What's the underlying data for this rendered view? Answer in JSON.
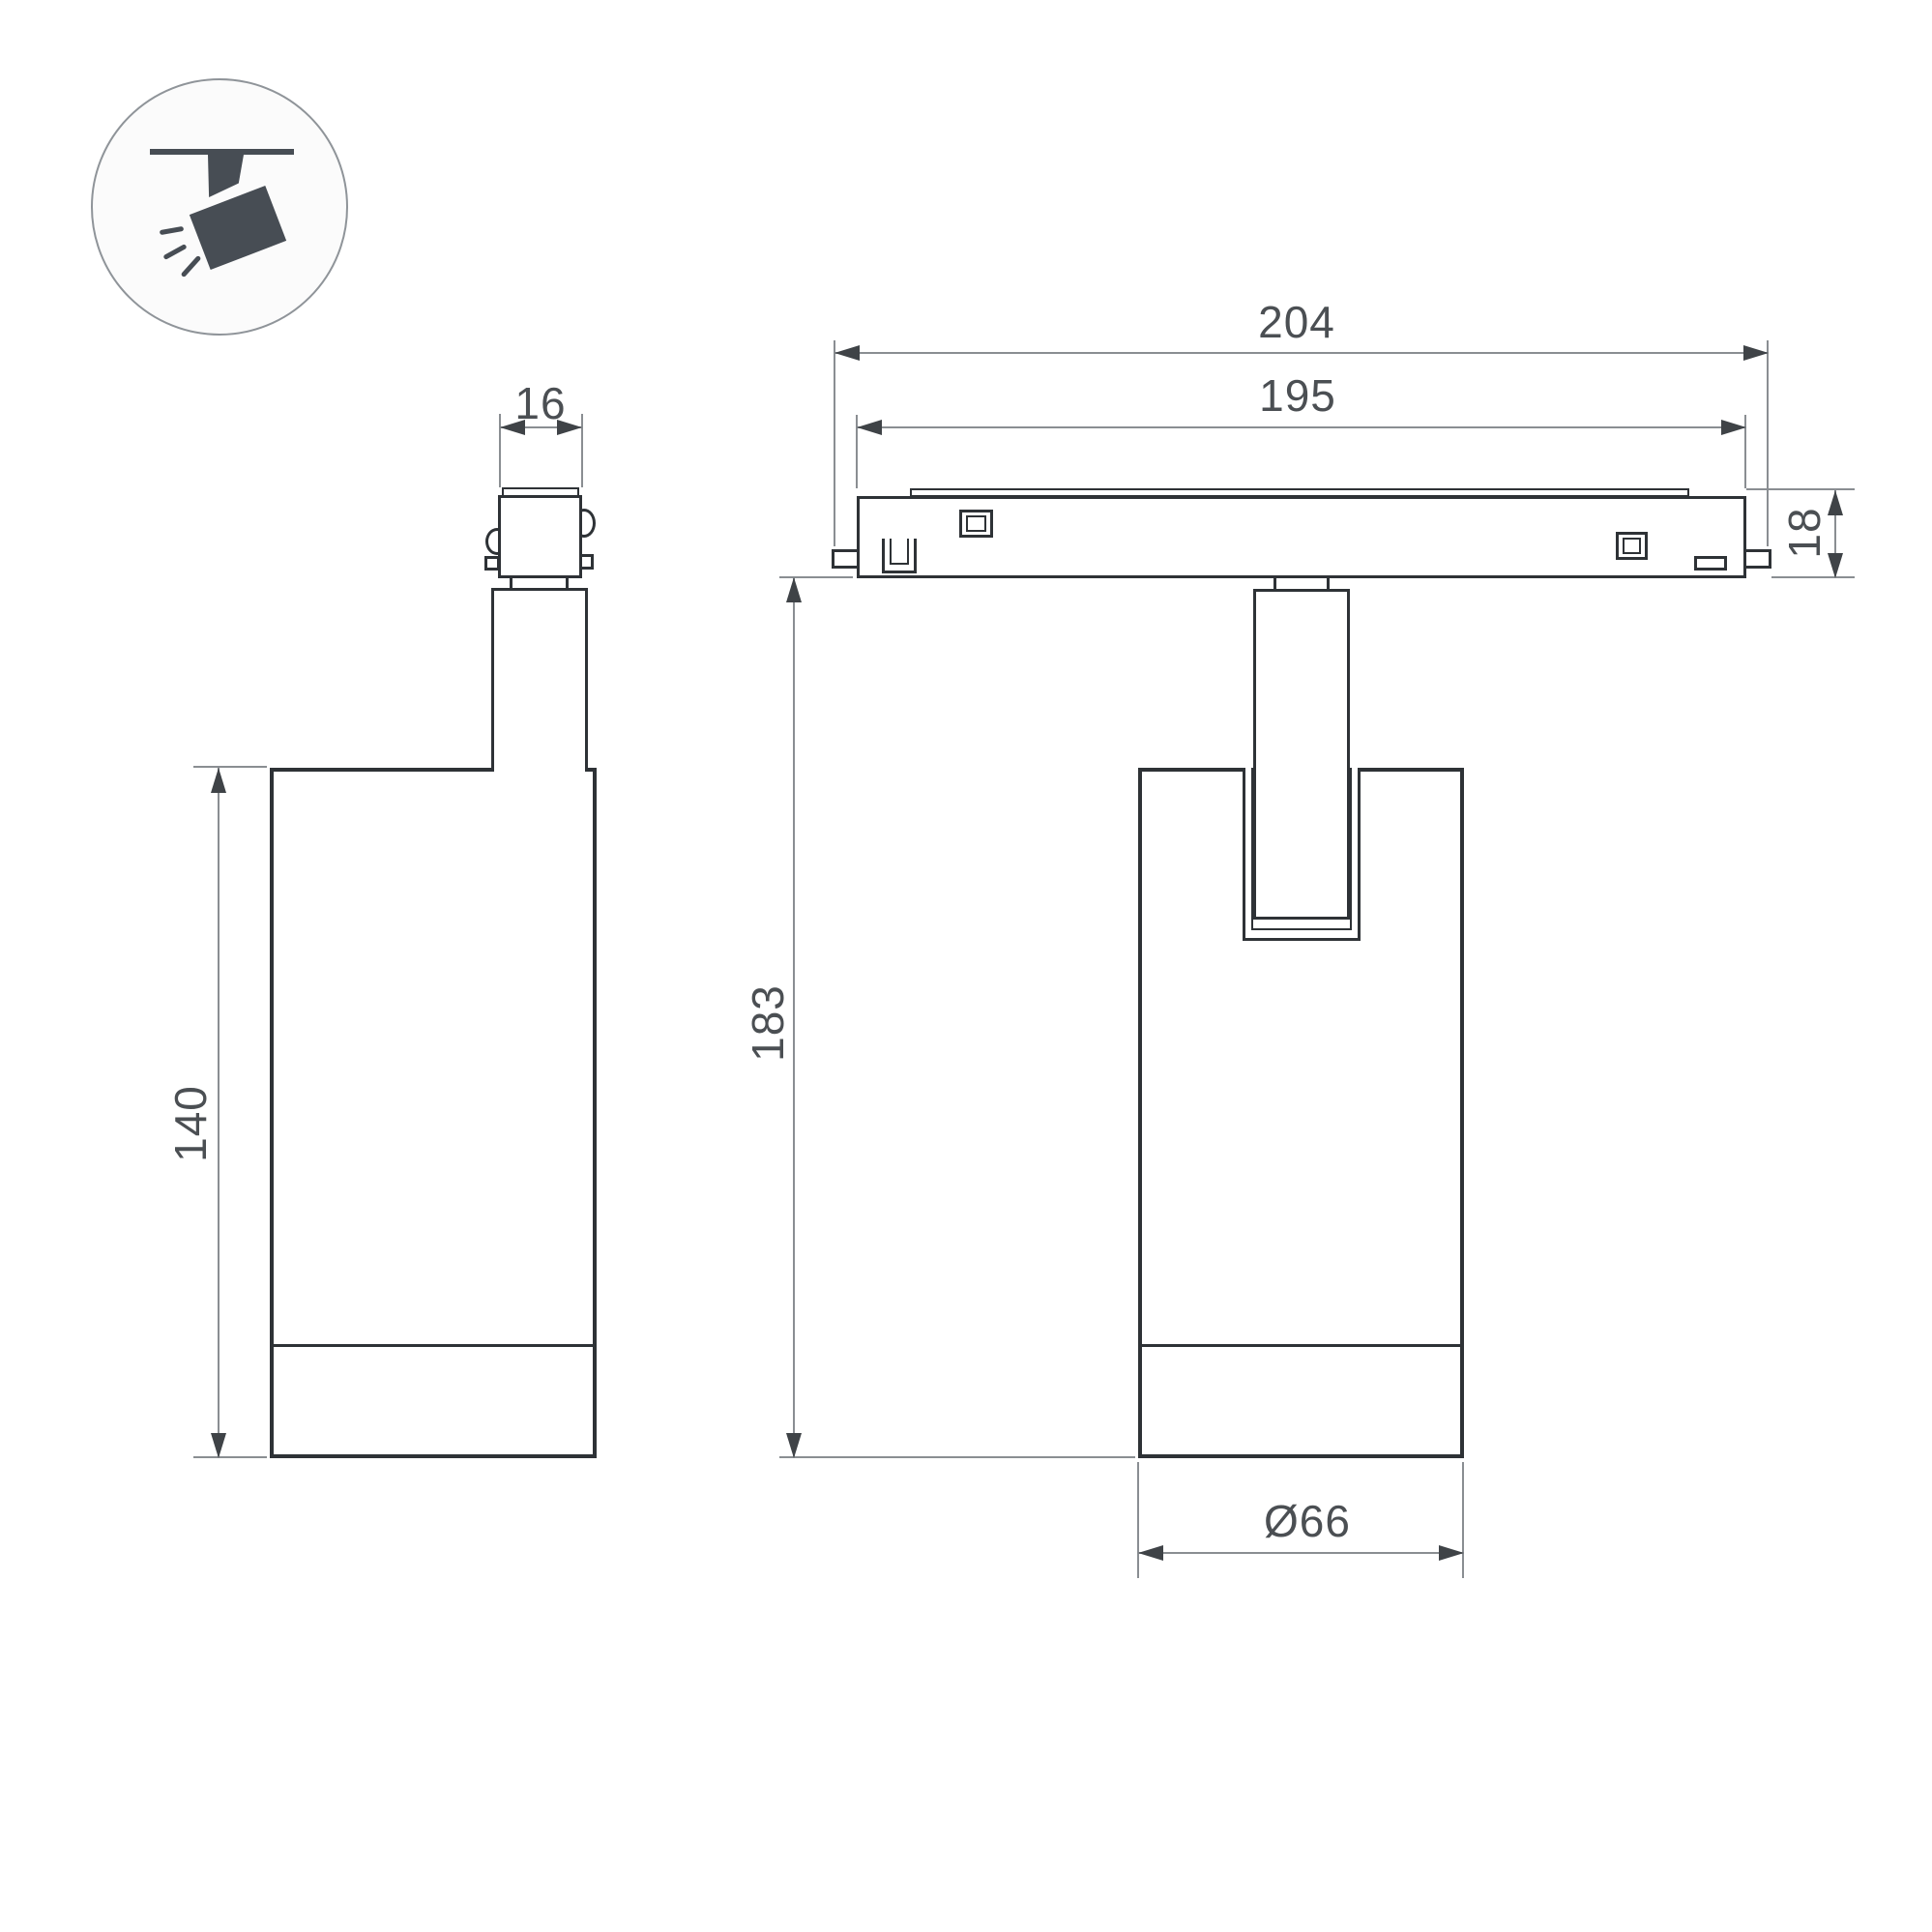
{
  "icon": {
    "name": "ceiling-track-spotlight",
    "fill": "#474d54",
    "ring_color": "#8f9499"
  },
  "colors": {
    "background": "#ffffff",
    "part_outline": "#2e3236",
    "dimension_line": "#8a8e92",
    "arrowhead": "#3f4347",
    "label_text": "#4b4f53"
  },
  "dimensions": {
    "connector_width": "16",
    "track_total_length": "204",
    "track_inner_length": "195",
    "track_height": "18",
    "overall_height": "183",
    "body_height": "140",
    "body_diameter": "Ø66"
  }
}
